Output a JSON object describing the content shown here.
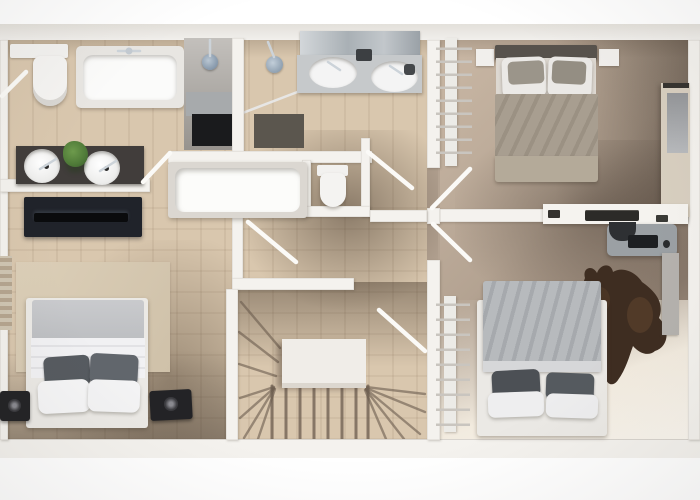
{
  "image": {
    "alt": "Top-down 3D rendered floor plan of an apartment upper floor",
    "kind": "3d-floor-plan-render"
  },
  "palette": {
    "pageBg": "#ffffff",
    "northBand": "#e3e0da",
    "wall": "#f4f2ee",
    "wallShade": "#d8d4ce",
    "doorWhite": "#fbfaf7",
    "floorLeft": "#d9c7ae",
    "floorRight": "#b4a392",
    "floorBright": "#f2ebdf",
    "woodLine": "#6b5c4e",
    "chrome": "#ccd3d9",
    "counterDark": "#413d3b",
    "basinWhite": "#f4f4f4",
    "plantGreen": "#4f7a38",
    "plantGreenDark": "#38592a",
    "tvPanel": "#20232a",
    "tvScreen": "#0a0b0d",
    "rugBeige": "#dccfb8",
    "bedWhite": "#f1f1f3",
    "blanketGray": "#c9cacd",
    "pillowDark": "#565b60",
    "speakerBlack": "#232326",
    "headboardDark": "#57524c",
    "duvetTaupe": "#a89e90",
    "duvetTaupeFoot": "#b4aa99",
    "pillowBeige": "#9b958a",
    "duvetSilver": "#b7babd",
    "duvetSilverFold": "#d6d7d9",
    "platformWhite": "#ebe9e5",
    "hideBrown": "#3e2d21",
    "hideLight": "#61452f",
    "wardrobeBeige": "#d8cfc0",
    "mirrorGray": "#95979a",
    "showerGray": "#a7aaac",
    "showerDark": "#1a1b1d",
    "matDark": "#5b564e",
    "vanityCounterGray": "#c6c9cb",
    "landing": "#f0ede8",
    "ladderWhite": "#ecebe7",
    "rungGray": "#c9c5bf",
    "chairGray": "#9ba0a4",
    "deskItemDark": "#2c2b28",
    "grayPanel": "#b5b2ae"
  },
  "objects": [
    "toilet",
    "bathtub",
    "shower-head",
    "shower-mat",
    "double-sink-vanity-mirror",
    "round-basin",
    "plant",
    "tv-lowboard",
    "bathtub-island",
    "wc-toilet",
    "double-bed-white",
    "speaker",
    "area-rug",
    "stair-landing",
    "winder-stairs",
    "ladder-rack",
    "double-bed-taupe",
    "nightstand",
    "wardrobe",
    "wall-desk",
    "office-chair-desk",
    "keyboard",
    "mouse",
    "cowhide-rug",
    "double-bed-silver",
    "open-door",
    "radiator"
  ],
  "rooms": [
    "bathroom-left",
    "bathroom-right",
    "wc",
    "hallway",
    "bedroom-bottom-left",
    "stairwell",
    "bedroom-top-right",
    "bedroom-bottom-right"
  ]
}
